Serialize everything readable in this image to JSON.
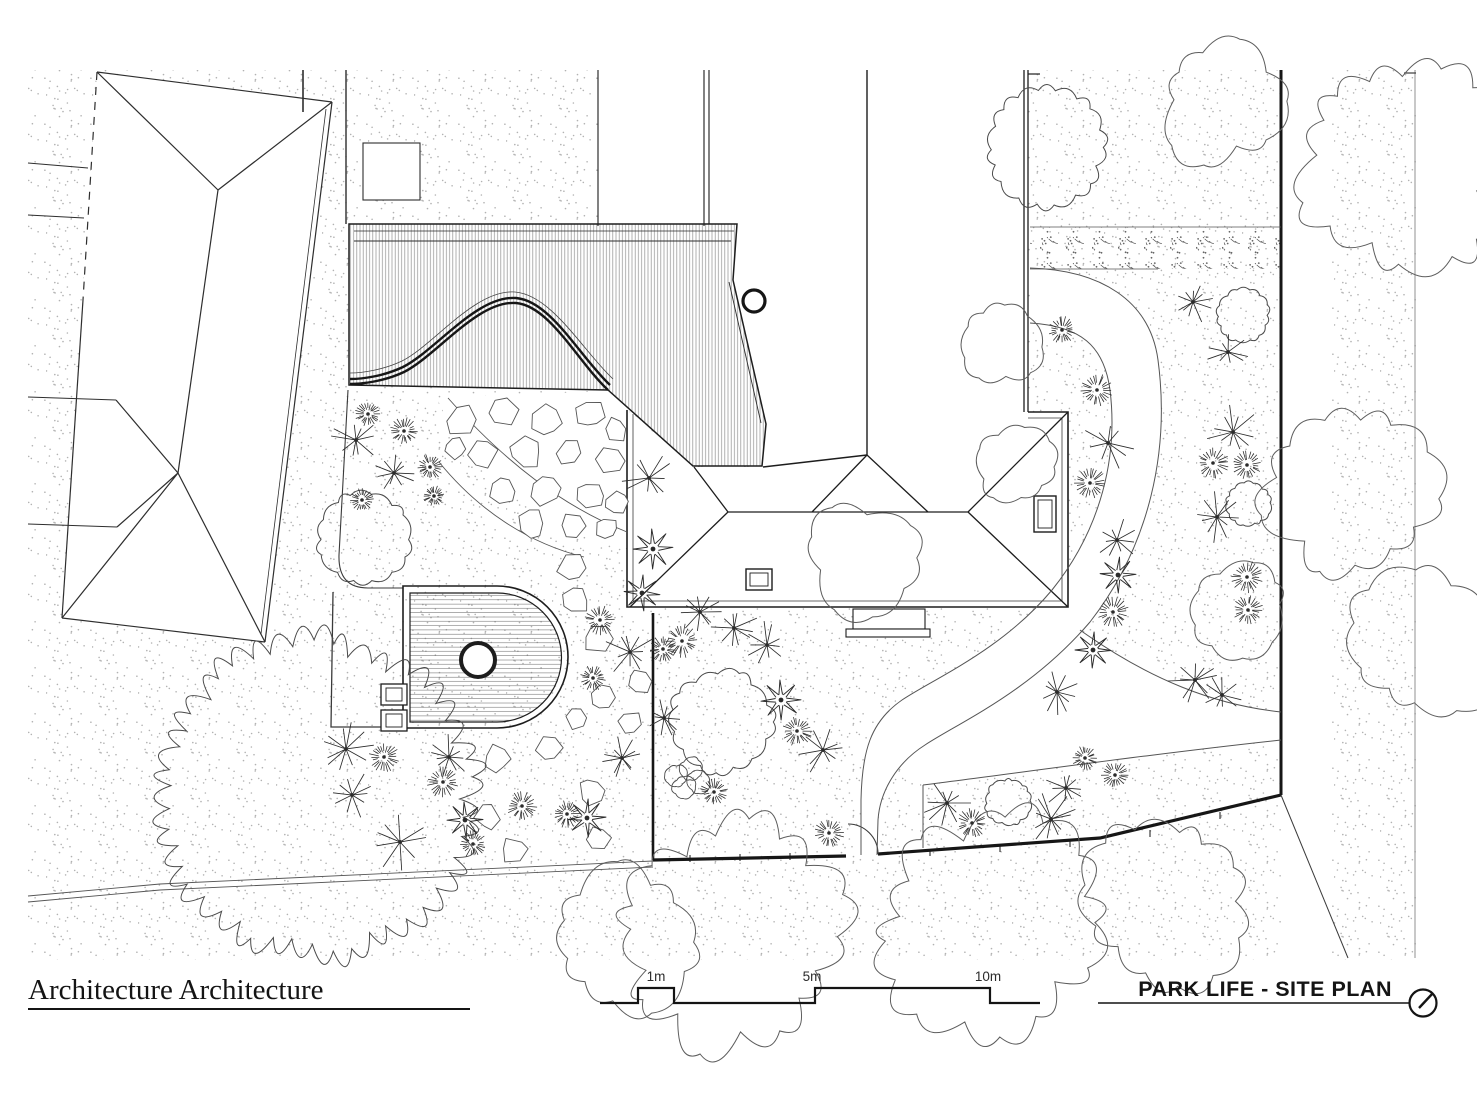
{
  "title_block": {
    "firm_name": "Architecture Architecture",
    "drawing_title": "PARK LIFE - SITE PLAN",
    "scale_labels": [
      "1m",
      "5m",
      "10m"
    ]
  },
  "colors": {
    "ink": "#161616",
    "line": "#3a3a3a",
    "soft": "#5a5a5a",
    "stipple": "#b2b2b2",
    "hatch": "#979797",
    "plank": "#6e6e6e",
    "plant": "#2b2b2b"
  },
  "plan": {
    "trees": [
      [
        1046,
        147,
        56
      ],
      [
        1243,
        315,
        25
      ],
      [
        1249,
        504,
        21
      ],
      [
        1008,
        802,
        22
      ],
      [
        363,
        538,
        44
      ],
      [
        722,
        722,
        49
      ],
      [
        317,
        797,
        150
      ]
    ],
    "canopies": [
      [
        1405,
        160,
        95
      ],
      [
        1222,
        100,
        58
      ],
      [
        1350,
        495,
        78
      ],
      [
        1425,
        645,
        68
      ],
      [
        1240,
        608,
        44
      ],
      [
        1015,
        465,
        36
      ],
      [
        862,
        558,
        52
      ],
      [
        1000,
        342,
        40
      ],
      [
        728,
        935,
        105
      ],
      [
        990,
        928,
        100
      ],
      [
        1165,
        905,
        75
      ],
      [
        625,
        938,
        68
      ]
    ],
    "plants": [
      [
        "d",
        368,
        414,
        12
      ],
      [
        "s",
        356,
        440,
        24
      ],
      [
        "d",
        404,
        431,
        13
      ],
      [
        "d",
        430,
        467,
        12
      ],
      [
        "s",
        394,
        473,
        20
      ],
      [
        "d",
        362,
        500,
        11
      ],
      [
        "d",
        434,
        496,
        10
      ],
      [
        "s",
        346,
        749,
        26
      ],
      [
        "d",
        384,
        757,
        14
      ],
      [
        "s",
        352,
        795,
        25
      ],
      [
        "s",
        400,
        842,
        28
      ],
      [
        "d",
        443,
        782,
        15
      ],
      [
        "s",
        449,
        757,
        22
      ],
      [
        "d",
        473,
        844,
        13
      ],
      [
        "d",
        522,
        806,
        14
      ],
      [
        "f",
        465,
        820,
        18
      ],
      [
        "s",
        649,
        478,
        26
      ],
      [
        "f",
        653,
        549,
        20
      ],
      [
        "d",
        600,
        620,
        14
      ],
      [
        "s",
        630,
        652,
        24
      ],
      [
        "d",
        663,
        649,
        13
      ],
      [
        "f",
        642,
        593,
        18
      ],
      [
        "d",
        567,
        814,
        13
      ],
      [
        "f",
        587,
        818,
        19
      ],
      [
        "s",
        622,
        758,
        20
      ],
      [
        "d",
        593,
        678,
        12
      ],
      [
        "s",
        700,
        612,
        24
      ],
      [
        "s",
        734,
        628,
        26
      ],
      [
        "d",
        682,
        641,
        16
      ],
      [
        "s",
        767,
        645,
        22
      ],
      [
        "f",
        781,
        700,
        20
      ],
      [
        "d",
        797,
        731,
        14
      ],
      [
        "s",
        823,
        750,
        24
      ],
      [
        "d",
        829,
        833,
        14
      ],
      [
        "b",
        676,
        776,
        11
      ],
      [
        "b",
        691,
        769,
        11
      ],
      [
        "b",
        684,
        787,
        11
      ],
      [
        "b",
        699,
        782,
        11
      ],
      [
        "d",
        714,
        792,
        13
      ],
      [
        "s",
        664,
        718,
        18
      ],
      [
        "d",
        1097,
        390,
        15
      ],
      [
        "s",
        1108,
        443,
        26
      ],
      [
        "d",
        1090,
        483,
        15
      ],
      [
        "s",
        1117,
        540,
        22
      ],
      [
        "f",
        1118,
        575,
        18
      ],
      [
        "d",
        1113,
        612,
        15
      ],
      [
        "f",
        1093,
        650,
        18
      ],
      [
        "s",
        1057,
        692,
        24
      ],
      [
        "d",
        1062,
        330,
        13
      ],
      [
        "s",
        1193,
        302,
        22
      ],
      [
        "s",
        1228,
        352,
        20
      ],
      [
        "s",
        1233,
        432,
        26
      ],
      [
        "d",
        1213,
        463,
        15
      ],
      [
        "d",
        1247,
        465,
        14
      ],
      [
        "s",
        1217,
        517,
        24
      ],
      [
        "d",
        1247,
        577,
        15
      ],
      [
        "d",
        1248,
        610,
        14
      ],
      [
        "s",
        1195,
        680,
        26
      ],
      [
        "s",
        1222,
        695,
        22
      ],
      [
        "s",
        947,
        803,
        24
      ],
      [
        "d",
        972,
        823,
        14
      ],
      [
        "s",
        1051,
        819,
        26
      ],
      [
        "s",
        1066,
        788,
        22
      ],
      [
        "d",
        1115,
        775,
        13
      ],
      [
        "d",
        1085,
        758,
        12
      ]
    ],
    "flagstones": [
      [
        462,
        420,
        17
      ],
      [
        502,
        413,
        16
      ],
      [
        546,
        420,
        17
      ],
      [
        590,
        414,
        15
      ],
      [
        616,
        431,
        13
      ],
      [
        482,
        453,
        16
      ],
      [
        526,
        452,
        17
      ],
      [
        570,
        452,
        15
      ],
      [
        610,
        460,
        14
      ],
      [
        503,
        492,
        16
      ],
      [
        547,
        490,
        16
      ],
      [
        590,
        496,
        14
      ],
      [
        617,
        503,
        12
      ],
      [
        532,
        523,
        14
      ],
      [
        572,
        526,
        13
      ],
      [
        607,
        528,
        12
      ],
      [
        455,
        447,
        12
      ]
    ],
    "stepping_stones": [
      [
        573,
        568,
        15
      ],
      [
        575,
        601,
        14
      ],
      [
        597,
        638,
        15
      ],
      [
        601,
        698,
        14
      ],
      [
        577,
        717,
        12
      ],
      [
        550,
        748,
        14
      ],
      [
        497,
        758,
        14
      ],
      [
        592,
        792,
        15
      ],
      [
        487,
        817,
        13
      ],
      [
        515,
        851,
        14
      ],
      [
        598,
        838,
        13
      ],
      [
        638,
        682,
        13
      ],
      [
        631,
        723,
        12
      ]
    ]
  }
}
